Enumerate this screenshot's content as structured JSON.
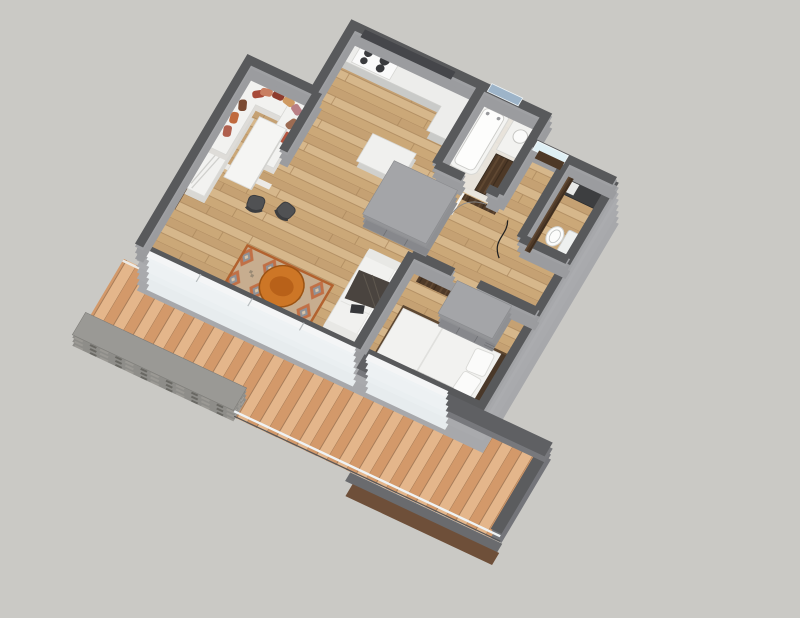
{
  "scene": {
    "description": "3D axonometric floor-plan render of a small one-bedroom apartment with a long wooden terrace, SketchUp-style visualization, no text labels",
    "camera": "top-down oblique from south-west",
    "background": "#cac9c5",
    "rooms": [
      {
        "name": "dining-nook",
        "items": [
          "walnut-wall-paneling",
          "u-shaped-bench",
          "throw-pillows",
          "dining-table",
          "dining-chairs"
        ],
        "pillow_count": 10,
        "chair_count": 2
      },
      {
        "name": "kitchen",
        "items": [
          "l-shaped-counter",
          "cooktop",
          "range-hood",
          "island-cabinet"
        ],
        "burner_count": 4
      },
      {
        "name": "bathroom",
        "items": [
          "bathtub",
          "washbasin-counter",
          "walnut-vanity",
          "blue-window"
        ]
      },
      {
        "name": "entry",
        "items": [
          "walnut-entrance-door",
          "transom-window",
          "outside-landing"
        ]
      },
      {
        "name": "wc",
        "items": [
          "toilet",
          "dark-vanity-counter",
          "walnut-wall-panel"
        ]
      },
      {
        "name": "hallway",
        "items": [
          "wardrobe-block",
          "floor-cable"
        ]
      },
      {
        "name": "bedroom",
        "items": [
          "double-bed",
          "walnut-headboard-panel",
          "closet-block",
          "radiator",
          "door-swing-arc"
        ]
      },
      {
        "name": "living-room",
        "items": [
          "sofa",
          "throw-blanket",
          "laptop",
          "patterned-area-rug",
          "round-coffee-table",
          "white-media-sideboard",
          "glass-terrace-doors"
        ]
      },
      {
        "name": "terrace",
        "items": [
          "wood-plank-deck",
          "stone-parapet",
          "glass-balustrade",
          "dark-fascia",
          "walnut-under-fascia"
        ]
      }
    ],
    "palette": {
      "background": "#cac9c5",
      "wall_top": "#58595b",
      "wall_side": "#9b9c9f",
      "wall_side_bright": "#a7a8ab",
      "floor_wood": "#cdab7f",
      "deck_wood": "#dca77b",
      "walnut": "#4e3927",
      "white_furniture": "#f2f2f0",
      "bath_floor": "#eae8e4",
      "rug_base": "#c7ad8f",
      "rug_orange": "#c06a3e",
      "rug_gray": "#8f9297",
      "table_orange": "#cd7626",
      "window_glass": "#dff0f5",
      "bath_window": "#9db4c9",
      "stone": "#8e8d89",
      "fixture_dark": "#3d3e40",
      "throw_dark": "#4a443f",
      "chair_dark": "#505153",
      "hood_dark": "#45464a",
      "pillow_colors": [
        "#a74b3a",
        "#c97f62",
        "#8e3b2e",
        "#cf9a62",
        "#b97f85",
        "#7a4a33",
        "#c06a3e",
        "#b0604e",
        "#9c6b52",
        "#b3543f"
      ]
    }
  }
}
